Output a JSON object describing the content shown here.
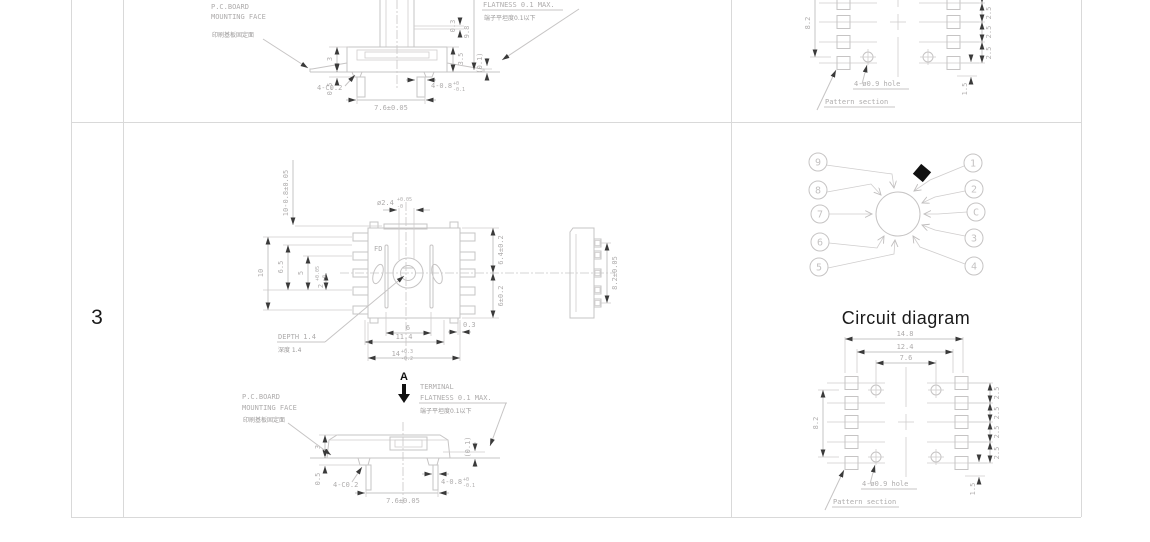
{
  "colors": {
    "frame": "#d9d9d9",
    "line": "#c6c4c4",
    "dim_text": "#aeacac",
    "black": "#111111"
  },
  "table": {
    "row_label": "3"
  },
  "pcb_note": {
    "line1": "P.C.BOARD",
    "line2": "MOUNTING  FACE",
    "cn": "印刷基板固定面"
  },
  "flatness_note": {
    "terminal": "TERMINAL",
    "en": "FLATNESS  0.1  MAX.",
    "cn": "端子平坦度0.1以下"
  },
  "view_label": "A",
  "side_view": {
    "d3": "3",
    "d05": "0.5",
    "c02": "4-C0.2",
    "d76": "7.6±0.05",
    "d01": "(0.1)",
    "d08_base": "4-0.8",
    "d08_up": "+0",
    "d08_dn": "-0.1",
    "d03": "0.3",
    "d98": "9.8",
    "d35": "3.5"
  },
  "main_view": {
    "shaft": "10-0.8±0.05",
    "hole_base": "ø2.4",
    "hole_up": "+0.05",
    "hole_dn": "-0",
    "c10": "10",
    "c65": "6.5",
    "c5": "5",
    "c2_base": "2",
    "c2_up": "+0.05",
    "c2_dn": "-0",
    "r64": "6.4±0.2",
    "r6": "6±0.2",
    "d03": "0.3",
    "b6": "6",
    "b114": "11.4",
    "b14_base": "14",
    "b14_up": "+0.3",
    "b14_dn": "-0.2",
    "depth_en": "DEPTH  1.4",
    "depth_cn": "深度  1.4",
    "marking": "FD",
    "side_dim": "8.2±0.05"
  },
  "pattern": {
    "d148": "14.8",
    "d124": "12.4",
    "d76": "7.6",
    "d82": "8.2",
    "pitch": "2.5",
    "d15": "1.5",
    "hole_label": "4-ø0.9  hole",
    "section_label": "Pattern  section"
  },
  "circuit": {
    "title": "Circuit diagram",
    "left_terminals": [
      "9",
      "8",
      "7",
      "6",
      "5"
    ],
    "right_terminals": [
      "1",
      "2",
      "C",
      "3",
      "4"
    ]
  }
}
